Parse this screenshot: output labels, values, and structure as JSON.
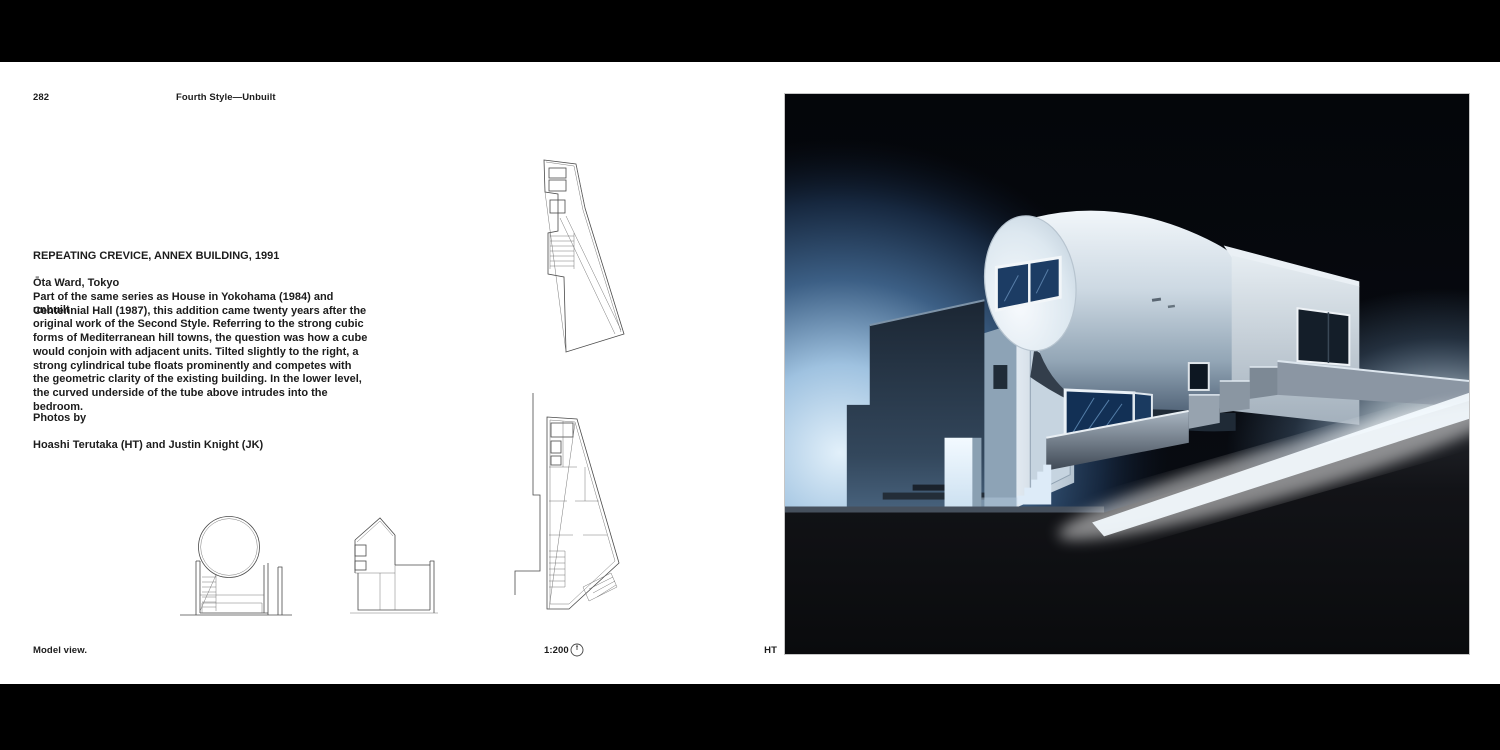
{
  "spread": {
    "page_number": "282",
    "running_header": "Fourth Style—Unbuilt",
    "project": {
      "title": "REPEATING CREVICE, ANNEX BUILDING, 1991",
      "location": "Ōta Ward, Tokyo",
      "status": "unbuilt"
    },
    "body_text": "Part of the same series as House in Yokohama (1984) and Centennial Hall (1987), this addition came twenty years after the original work of the Second Style. Referring to the strong cubic forms of Mediterranean hill towns, the question was how a cube would conjoin with adjacent units. Tilted slightly to the right, a strong cylindrical tube floats prominently and competes with the geometric clarity of the existing building. In the lower level, the curved underside of the tube above intrudes into the bedroom.",
    "credits": {
      "label": "Photos by",
      "names": "Hoashi Terutaka (HT) and Justin Knight (JK)"
    },
    "caption": "Model view.",
    "drawing_scale": "1:200",
    "photo_credit": "HT"
  },
  "colors": {
    "letterbox": "#000000",
    "page_background": "#ffffff",
    "text": "#1c1c1c",
    "drawing_line": "#4a4a4a",
    "photo_background": "#07090d",
    "photo_blue_glow": "#d9eaf8",
    "model_white": "#e8eef3",
    "glass_blue": "#123055"
  }
}
